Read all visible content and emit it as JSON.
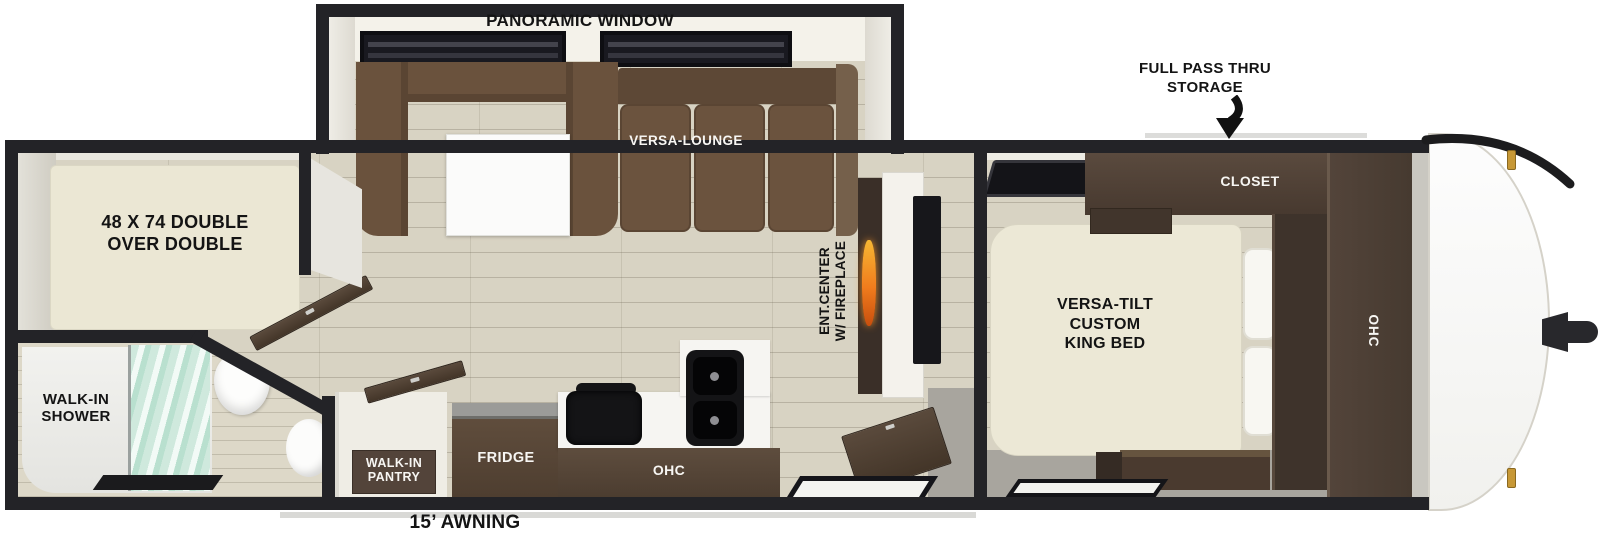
{
  "plan_title": "travel-trailer floor plan",
  "callouts": {
    "storage_line1": "FULL PASS THRU",
    "storage_line2": "STORAGE",
    "awning": "15’ AWNING"
  },
  "slideout": {
    "window_label": "PANORAMIC WINDOW",
    "lounge_label": "VERSA-LOUNGE"
  },
  "living": {
    "ent_line1": "ENT.CENTER",
    "ent_line2": "W/ FIREPLACE"
  },
  "bedroom": {
    "closet": "CLOSET",
    "bed_line1": "VERSA-TILT",
    "bed_line2": "CUSTOM",
    "bed_line3": "KING BED",
    "ohc": "OHC"
  },
  "bunkroom": {
    "bunk_line1": "48 X 74 DOUBLE",
    "bunk_line2": "OVER DOUBLE"
  },
  "bathroom": {
    "shower_line1": "WALK-IN",
    "shower_line2": "SHOWER"
  },
  "kitchen": {
    "pantry_line1": "WALK-IN",
    "pantry_line2": "PANTRY",
    "fridge": "FRIDGE",
    "ohc": "OHC"
  },
  "colors": {
    "wall": "#232327",
    "floor_wood": "#d8d3c3",
    "bedroom_gray": "#a8a59e",
    "sofa": "#6b533e",
    "sofa_back": "#5d4836",
    "cabinet": "#4f4034",
    "cabinet_dark": "#3e332b",
    "mattress": "#ebe7d4",
    "counter_white": "#f6f5f2",
    "appliance_black": "#141416",
    "shower_glass": "#cfe8dd",
    "flame_orange": "#f07c1d",
    "marker_gold": "#c79836"
  }
}
